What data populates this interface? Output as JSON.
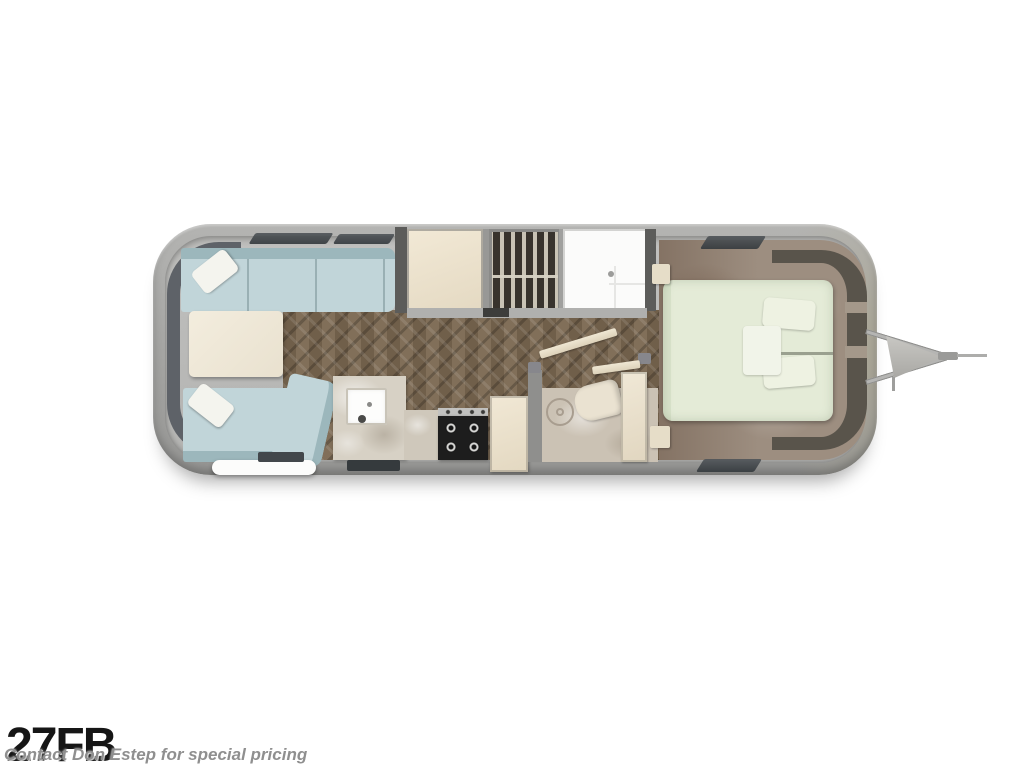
{
  "caption": {
    "model": "27FB",
    "watermark": "Contact Don Estep for special pricing"
  },
  "palette": {
    "wall": "#a6a6a4",
    "walkway": "#b9b9b7",
    "wood": "#7a6750",
    "sofa": "#c1d5d9",
    "sofa_back": "#9cb7bc",
    "pillow": "#f4f4ee",
    "cream": "#efe8d7",
    "marble": "#d7d1c5",
    "stove": "#1d1d1d",
    "wardrobe": "#38332d",
    "shower": "#fbfbfa",
    "carpet": "#9d8e80",
    "bed": "#e4ebd7",
    "headboard": "#59544b",
    "window": "#3e4347",
    "text_dark": "#161616",
    "text_watermark": "#8f8f8f"
  }
}
